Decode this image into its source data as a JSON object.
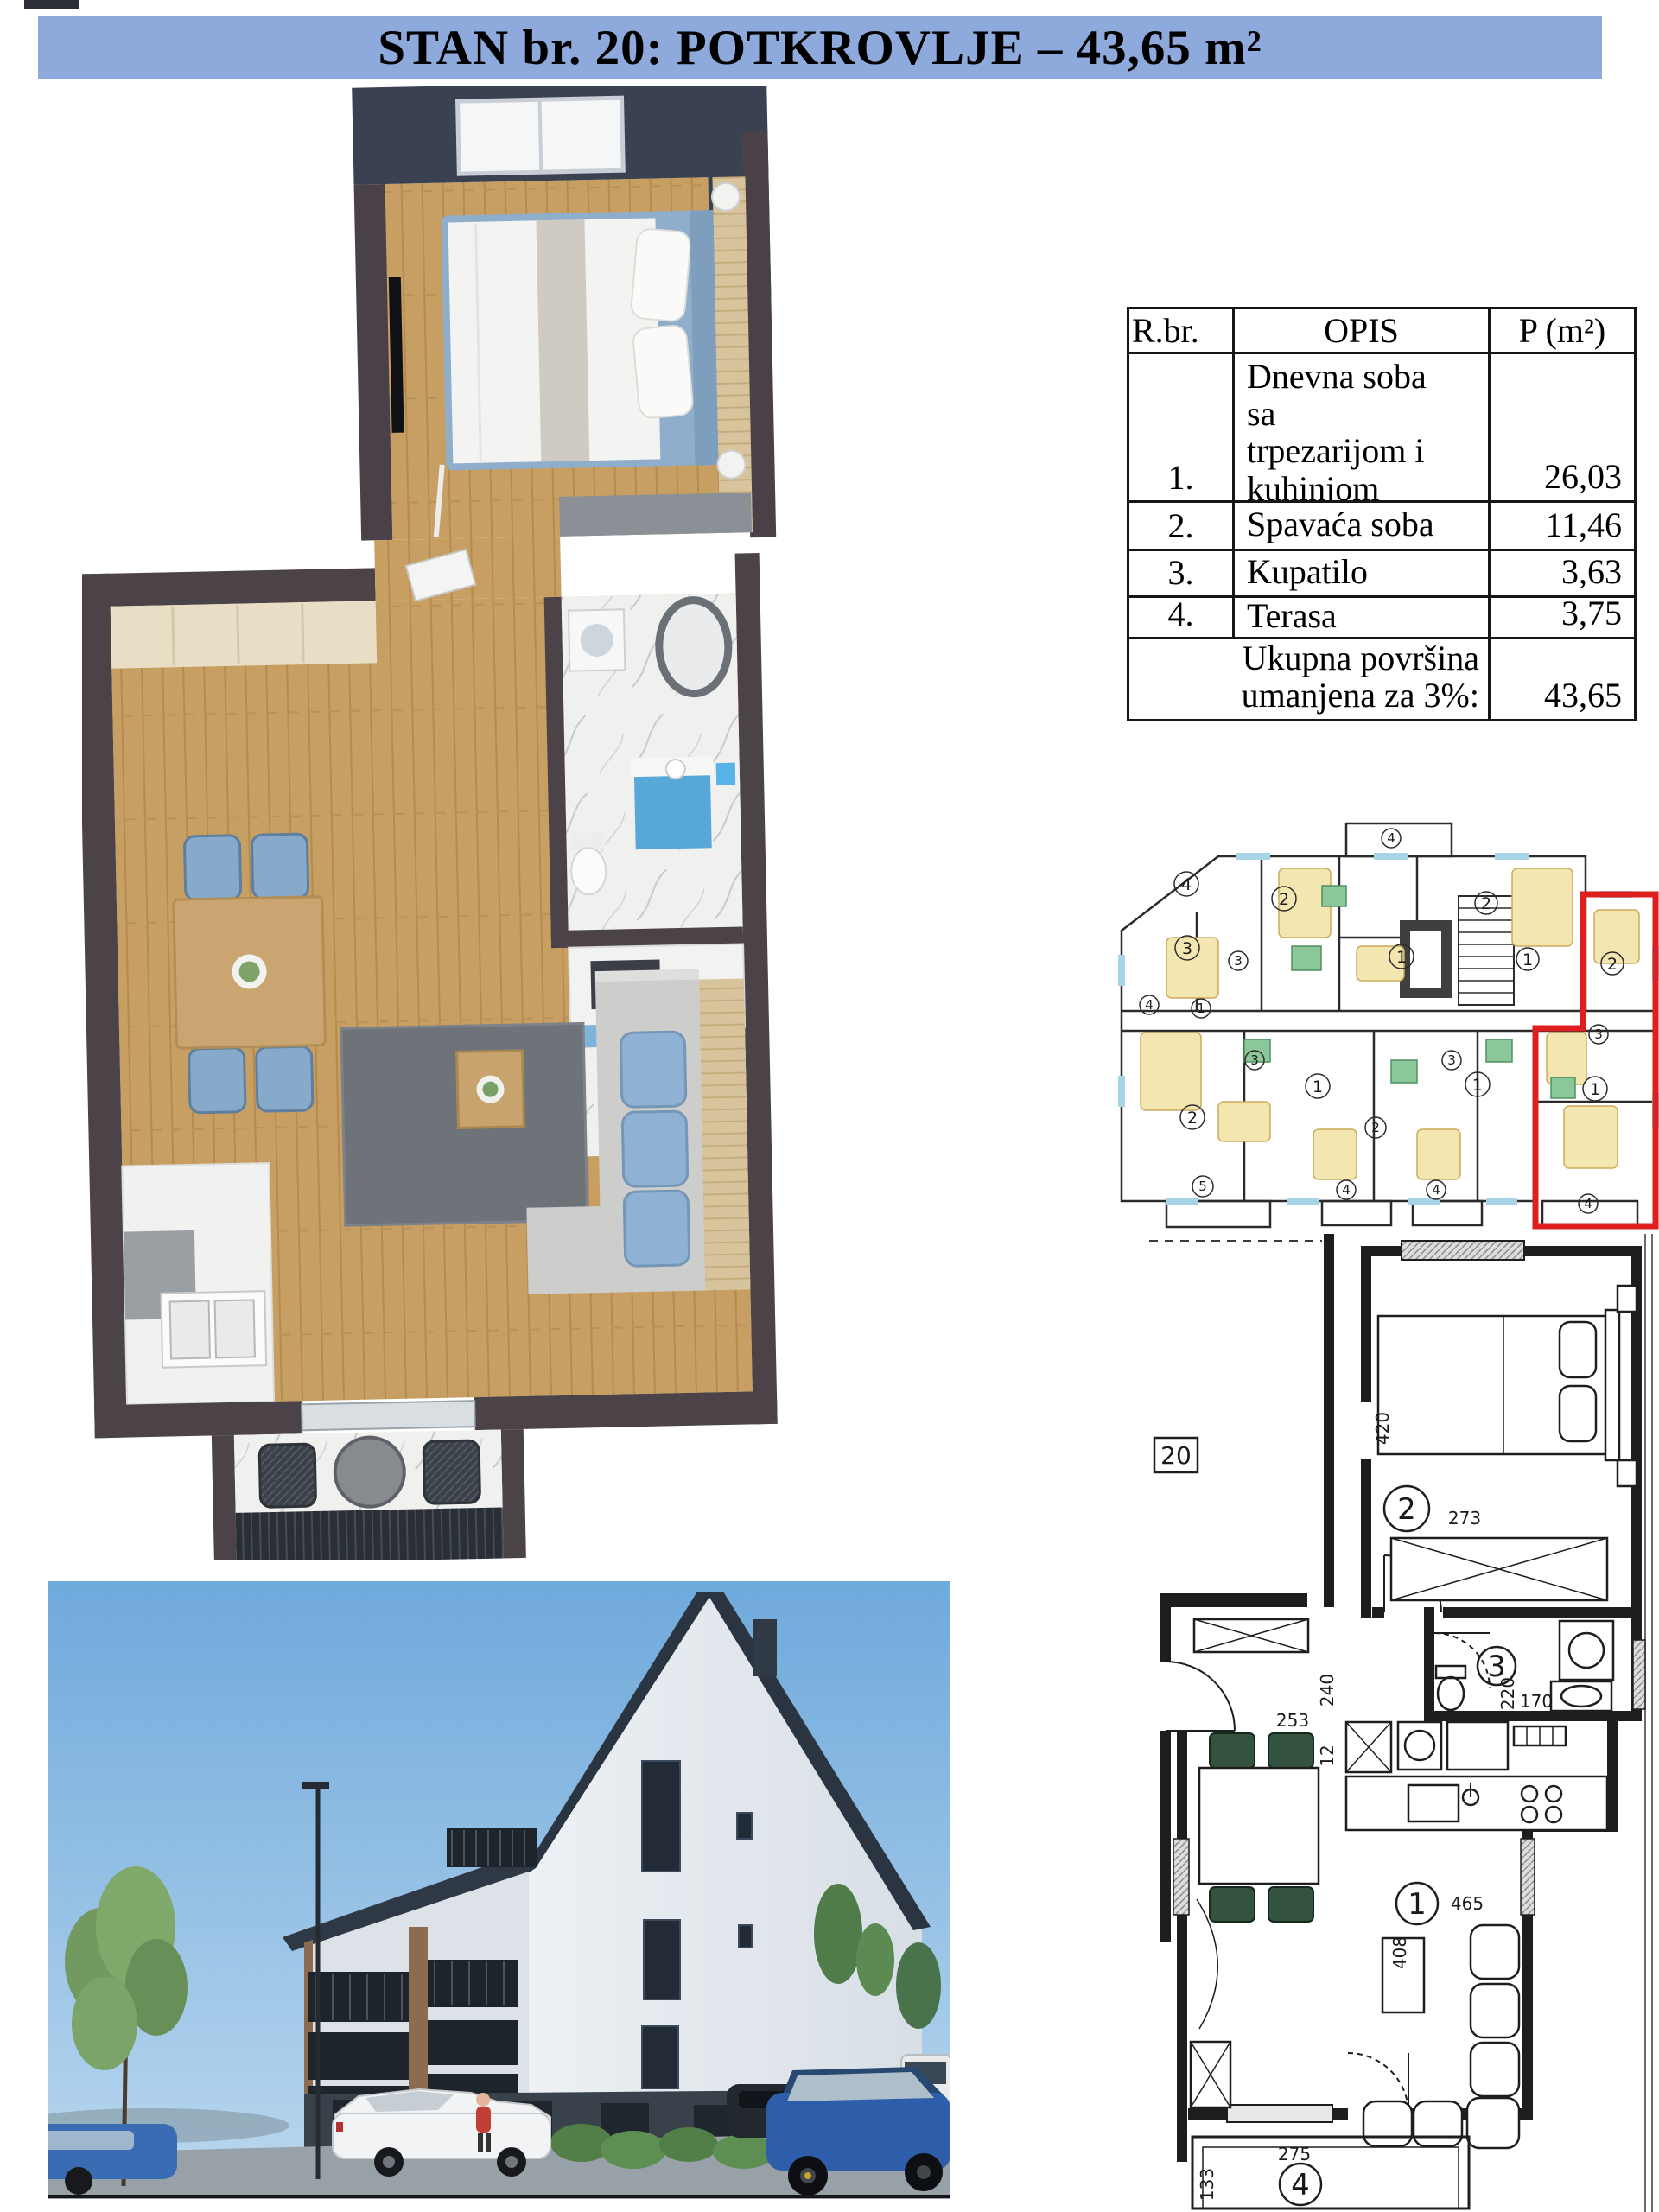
{
  "title": {
    "text": "STAN br. 20: POTKROVLJE – 43,65 m²"
  },
  "colors": {
    "header_bg": "#8EA9DB",
    "highlight_red": "#DE1F1F"
  },
  "area_table": {
    "headers": [
      "R.br.",
      "OPIS",
      "P (m²)"
    ],
    "rows": [
      {
        "num": "1.",
        "desc_lines": [
          "Dnevna soba",
          "sa",
          "trpezarijom i",
          "kuhinjom"
        ],
        "area": "26,03"
      },
      {
        "num": "2.",
        "desc": "Spavaća soba",
        "area": "11,46"
      },
      {
        "num": "3.",
        "desc": "Kupatilo",
        "area": "3,63"
      },
      {
        "num": "4.",
        "desc": "Terasa",
        "area": "3,75"
      }
    ],
    "footer": {
      "label_lines": [
        "Ukupna površina",
        "umanjena za 3%:"
      ],
      "value": "43,65"
    }
  },
  "floor_overview": {
    "unit_labels": [
      "4",
      "3",
      "2",
      "1",
      "3",
      "4",
      "1",
      "2",
      "3",
      "1",
      "2",
      "1",
      "3",
      "5",
      "4",
      "4",
      "2",
      "3",
      "1",
      "4",
      "2",
      "1",
      "4"
    ]
  },
  "unit_plan": {
    "apartment_number": "20",
    "room_labels": {
      "bedroom": "2",
      "bathroom": "3",
      "living": "1",
      "terrace": "4"
    },
    "dimensions": {
      "bedroom_length": "420",
      "bedroom_width": "273",
      "hall_depth": "240",
      "hall_width": "253",
      "bath_a": "220",
      "bath_b": "170",
      "kitchen_step": "12",
      "living_width": "465",
      "living_depth": "408",
      "terrace_width": "275",
      "terrace_depth": "133"
    }
  }
}
